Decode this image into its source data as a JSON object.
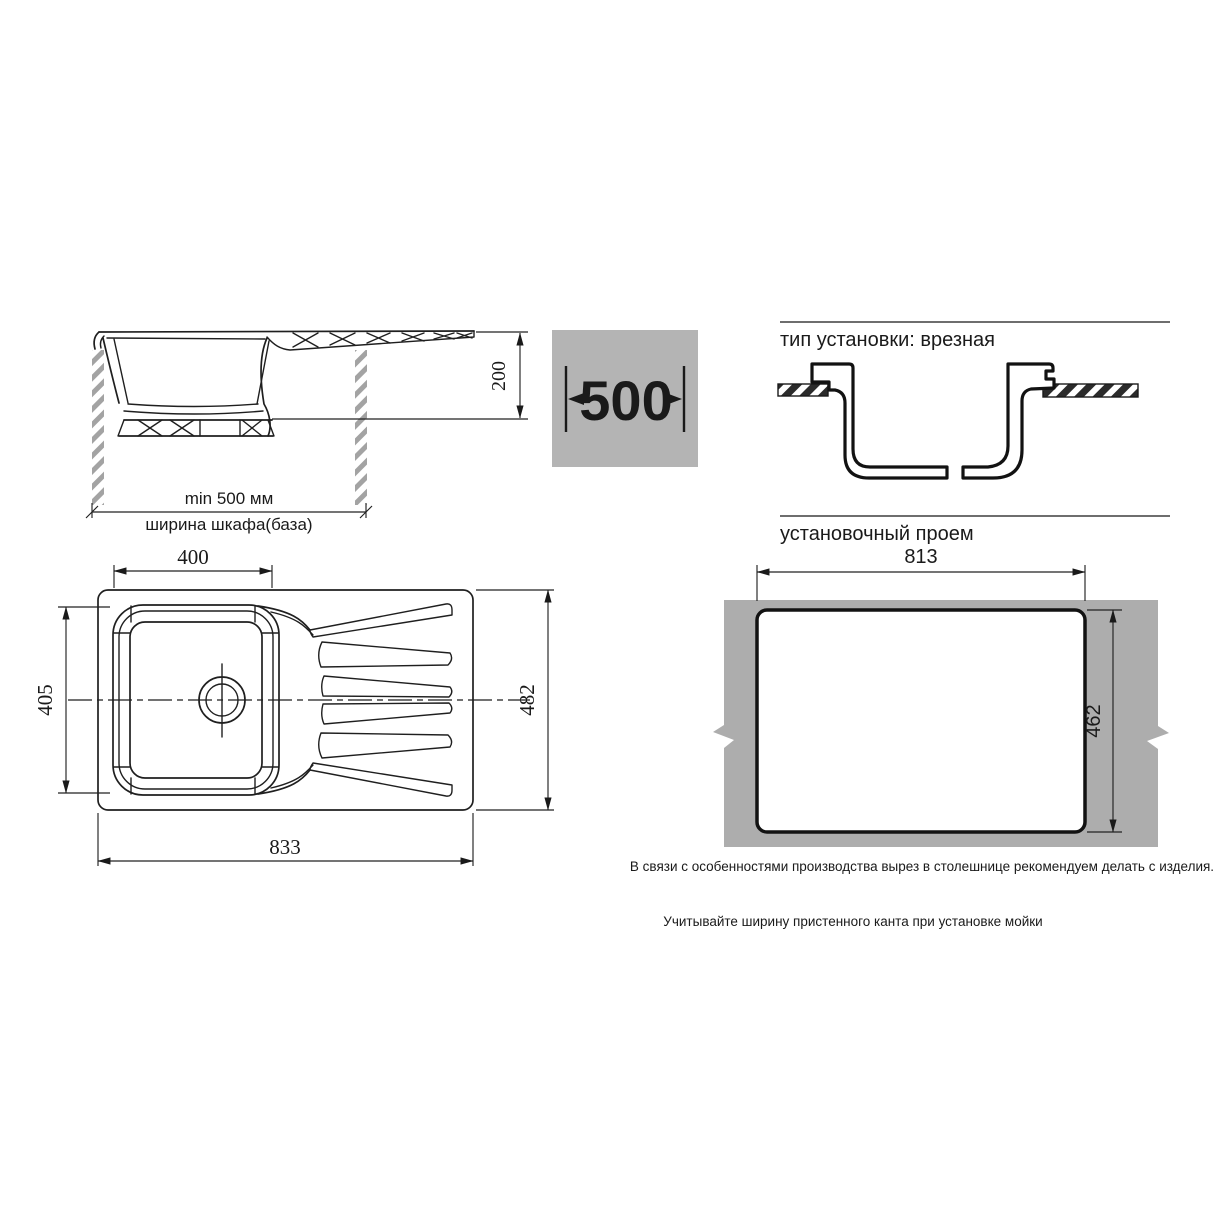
{
  "side_view": {
    "depth_label": "200",
    "min_width_label": "min 500 мм",
    "cabinet_label": "ширина шкафа(база)"
  },
  "spacer": {
    "label": "500"
  },
  "install": {
    "type_heading": "тип установки: врезная",
    "opening_heading": "установочный проем",
    "opening_width": "813",
    "opening_height": "462",
    "note_cutout": "В связи с особенностями производства вырез в столешнице рекомендуем делать с изделия.",
    "note_edge": "Учитывайте ширину пристенного канта при установке мойки"
  },
  "top_view": {
    "bowl_width": "400",
    "bowl_depth": "405",
    "overall_depth": "482",
    "overall_width": "833"
  },
  "colors": {
    "panel_gray": "#b4b4b4",
    "countertop_gray": "#adadad",
    "hatch_gray": "#a3a3a3",
    "line_black": "#1a1a1a"
  }
}
